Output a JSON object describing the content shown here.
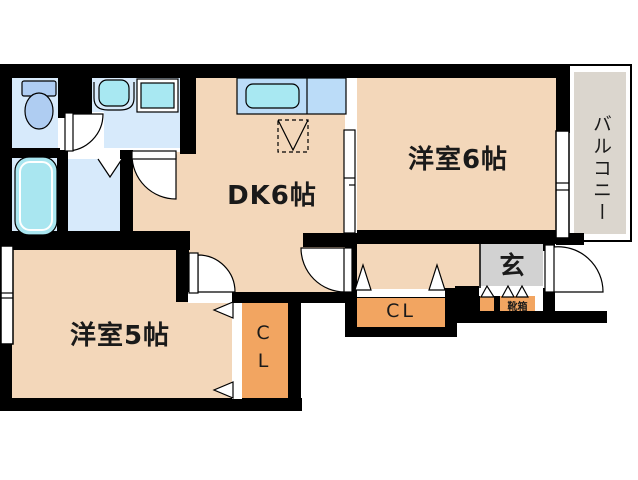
{
  "plan": {
    "rooms": {
      "dk": "DK6帖",
      "bedroom6": "洋室6帖",
      "bedroom5": "洋室5帖",
      "balcony": "バルコニー",
      "entrance": "玄",
      "shoe_box": "靴箱",
      "closet_bedroom5": "CL",
      "closet_hall": "CL"
    },
    "colors": {
      "wall": "#000000",
      "room_floor": "#F3D7BA",
      "wet_room_floor": "#D7EAFB",
      "closet_fill": "#F2A561",
      "entrance_floor": "#D2D2D2",
      "balcony_floor": "#DBD6CE",
      "kitchen_counter": "#BBDCF8",
      "fixture_cyan": "#A8E8F2",
      "toilet_fixture_blue": "#AFCDF2"
    },
    "fixtures": [
      "toilet",
      "bathtub",
      "washbasin",
      "washing-machine-space",
      "kitchen-sink",
      "refrigerator-space"
    ]
  }
}
